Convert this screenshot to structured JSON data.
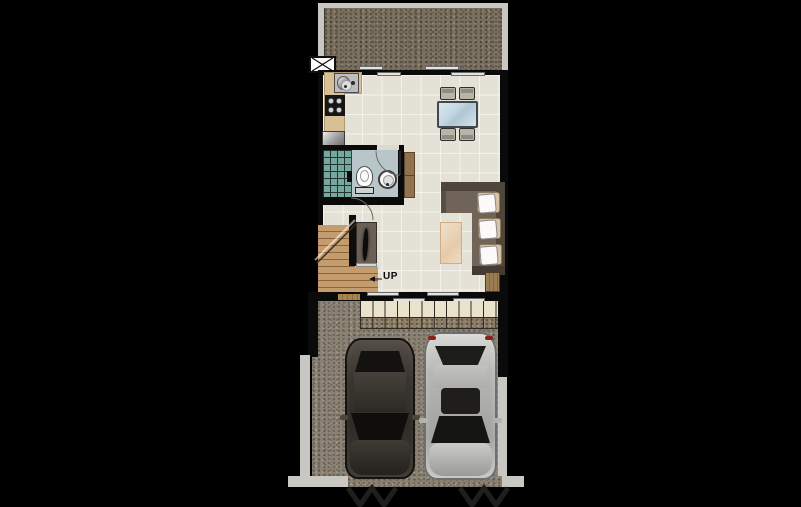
{
  "scene": {
    "type": "architectural floor plan, ground floor of a townhouse, top-down view on black background",
    "background_color": "#000000"
  },
  "labels": {
    "stairs_direction": "UP"
  },
  "palette": {
    "wall": "#0a0a0a",
    "floor_tile": "#e4e1d6",
    "tile_grout": "#f4f2ec",
    "kitchen_counter": "#d8bf94",
    "stairs_wood": "#c59c6d",
    "bathroom_floor": "#b9c6c9",
    "shower_tile": "#76a8a0",
    "sofa": "#6f6457",
    "cushion": "#d9c3a4",
    "rug": "#eed9c0",
    "dining_glass": "#ccdde8",
    "backyard_ground": "#7b7060",
    "driveway": "#8b8274",
    "porch_tile_cream": "#eae3cc",
    "porch_tile_brown": "#8d7c64",
    "fence": "#c9c7c2",
    "car_dark": "#37332e",
    "car_silver": "#b4b4b2",
    "taillight_red": "#8a2018"
  },
  "elements": [
    "backyard",
    "ac-condenser-unit",
    "sliding-doors",
    "kitchen-counter",
    "kitchen-sink",
    "stove",
    "refrigerator",
    "dining-table",
    "dining-chairs",
    "bathroom",
    "shower",
    "toilet",
    "basin",
    "bathroom-cabinet",
    "stairs",
    "tv-cabinet",
    "l-shaped-sofa",
    "cushions",
    "rug",
    "side-table",
    "front-windows",
    "porch-tiles",
    "driveway",
    "dark-car",
    "silver-car",
    "fence",
    "gates"
  ]
}
